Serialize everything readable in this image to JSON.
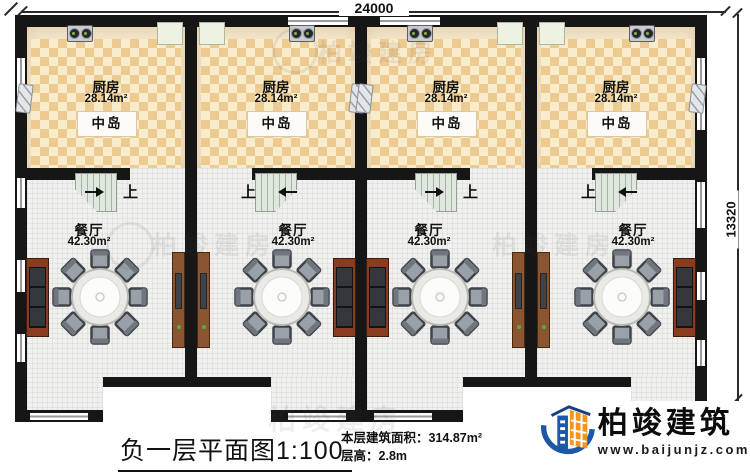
{
  "dimensions": {
    "top": "24000",
    "right": "13320"
  },
  "rooms": {
    "kitchen_name": "厨房",
    "kitchen_area": "28.14m²",
    "island": "中岛",
    "dining_name": "餐厅",
    "dining_area": "42.30m²",
    "stairs_up": "上"
  },
  "titleblock": {
    "plan_title": "负一层平面图",
    "scale": "1:100",
    "floor_area_label": "本层建筑面积：",
    "floor_area_value": "314.87m²",
    "floor_height_label": "层高：",
    "floor_height_value": "2.8m"
  },
  "brand": {
    "name": "柏竣建筑",
    "website": "www.baijunjz.com"
  },
  "watermark": "柏竣建房",
  "colors": {
    "wall": "#161616",
    "checker_dark": "#ecca90",
    "checker_light": "#f9eccd",
    "brand_blue": "#1b59a8",
    "brand_orange": "#f7941d"
  }
}
